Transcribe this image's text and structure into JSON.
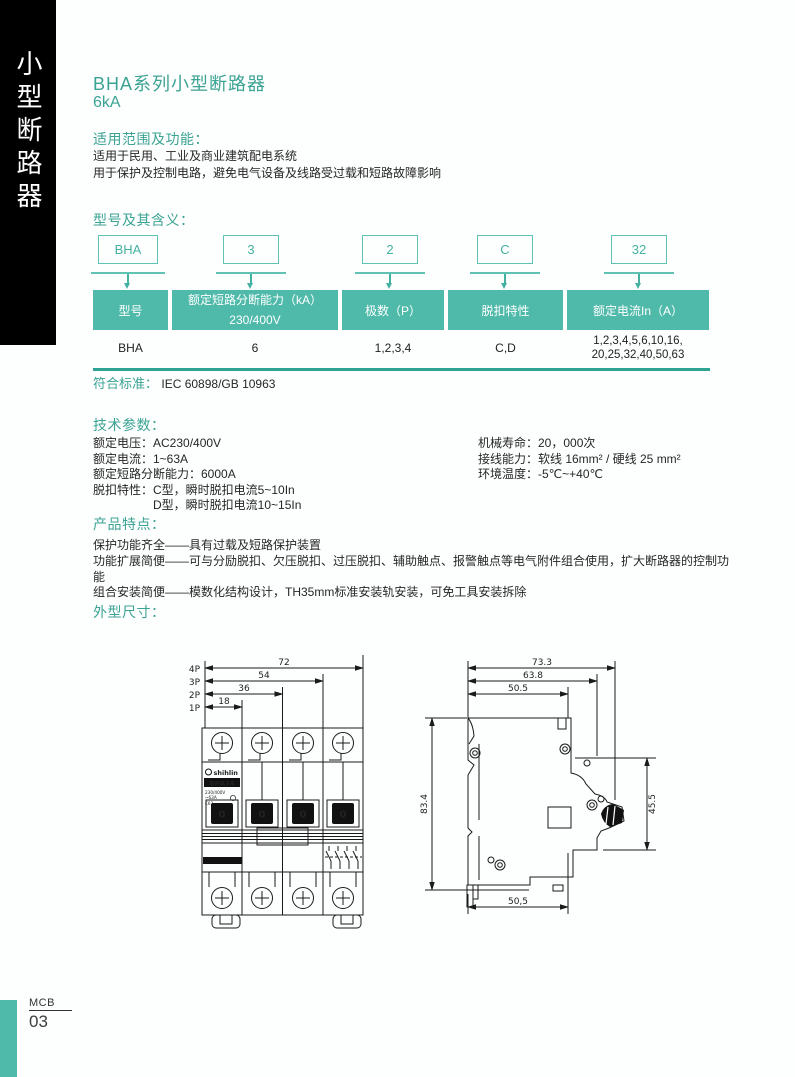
{
  "accent_colors": {
    "heading": "#3BA393",
    "table_header": "#4FBAAA",
    "box_border": "#5FC2B2"
  },
  "side_tab": {
    "vertical_title": "小型断路器"
  },
  "title": {
    "main": "BHA系列小型断路器",
    "sub": "6kA"
  },
  "scope": {
    "heading": "适用范围及功能：",
    "line1": "适用于民用、工业及商业建筑配电系统",
    "line2": "用于保护及控制电路，避免电气设备及线路受过载和短路故障影响"
  },
  "model": {
    "heading": "型号及其含义：",
    "boxes": [
      "BHA",
      "3",
      "2",
      "C",
      "32"
    ],
    "table": {
      "col1_header": "型号",
      "col2_header_top": "额定短路分断能力（kA）",
      "col2_header_bottom": "230/400V",
      "col3_header": "极数（P）",
      "col4_header": "脱扣特性",
      "col5_header": "额定电流In（A）",
      "row": {
        "col1": "BHA",
        "col2": "6",
        "col3": "1,2,3,4",
        "col4": "C,D",
        "col5_line1": "1,2,3,4,5,6,10,16,",
        "col5_line2": "20,25,32,40,50,63"
      }
    }
  },
  "standard": {
    "label": "符合标准：",
    "value": "IEC 60898/GB 10963"
  },
  "tech": {
    "heading": "技术参数：",
    "left": {
      "l1": "额定电压：AC230/400V",
      "l2": "额定电流：1~63A",
      "l3": "额定短路分断能力：6000A",
      "l4": "脱扣特性：C型，瞬时脱扣电流5~10In",
      "l5": "D型，瞬时脱扣电流10~15In"
    },
    "right": {
      "r1": "机械寿命：20，000次",
      "r2": "接线能力：软线 16mm² / 硬线 25 mm²",
      "r3": "环境温度：-5℃~+40℃"
    }
  },
  "features": {
    "heading": "产品特点：",
    "line1": "保护功能齐全——具有过载及短路保护装置",
    "line2": "功能扩展简便——可与分励脱扣、欠压脱扣、过压脱扣、辅助触点、报警触点等电气附件组合使用，扩大断路器的控制功能",
    "line3": "组合安装简便——模数化结构设计，TH35mm标准安装轨安装，可免工具安装拆除"
  },
  "dimensions": {
    "heading": "外型尺寸：",
    "front_view": {
      "pole_labels": [
        "4P",
        "3P",
        "2P",
        "1P"
      ],
      "width_dims": [
        "72",
        "54",
        "36",
        "18"
      ],
      "brand": "shihlin",
      "model_label": "BHA34",
      "nameplate": [
        "230/400V",
        "~63A",
        "C63"
      ],
      "toggle_label": "0"
    },
    "side_view": {
      "dim_top1": "73.3",
      "dim_top2": "63.8",
      "dim_top3": "50.5",
      "dim_height": "83.4",
      "dim_right": "45.5",
      "dim_bottom": "50,5"
    }
  },
  "footer": {
    "label": "MCB",
    "page": "03"
  }
}
